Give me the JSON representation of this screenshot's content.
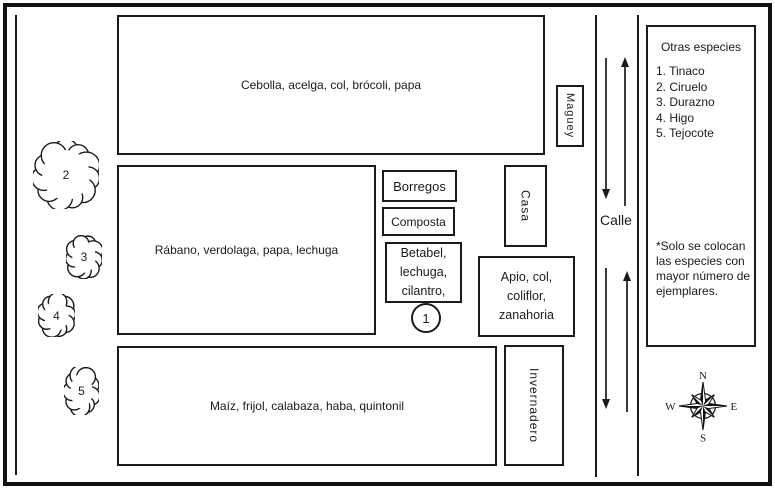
{
  "map": {
    "plot_top": "Cebolla, acelga, col, brócoli, papa",
    "plot_middle": "Rábano, verdolaga, papa, lechuga",
    "plot_bottom": "Maíz, frijol, calabaza, haba, quintonil",
    "borregos": "Borregos",
    "composta": "Composta",
    "betabel": "Betabel, lechuga, cilantro,",
    "apio": "Apio, col, coliflor, zanahoria",
    "casa": "Casa",
    "maguey": "Maguey",
    "invernadero": "Invernadero",
    "calle": "Calle",
    "tinaco_marker": "1"
  },
  "trees": [
    "2",
    "3",
    "4",
    "5"
  ],
  "legend": {
    "title": "Otras especies",
    "items": [
      "1. Tinaco",
      "2. Ciruelo",
      "3. Durazno",
      "4. Higo",
      "5. Tejocote"
    ],
    "note": "*Solo se colocan las especies con mayor número de ejemplares."
  },
  "compass": {
    "n": "N",
    "e": "E",
    "s": "S",
    "w": "W"
  },
  "colors": {
    "ink": "#1b1b1b",
    "background": "#ffffff"
  }
}
